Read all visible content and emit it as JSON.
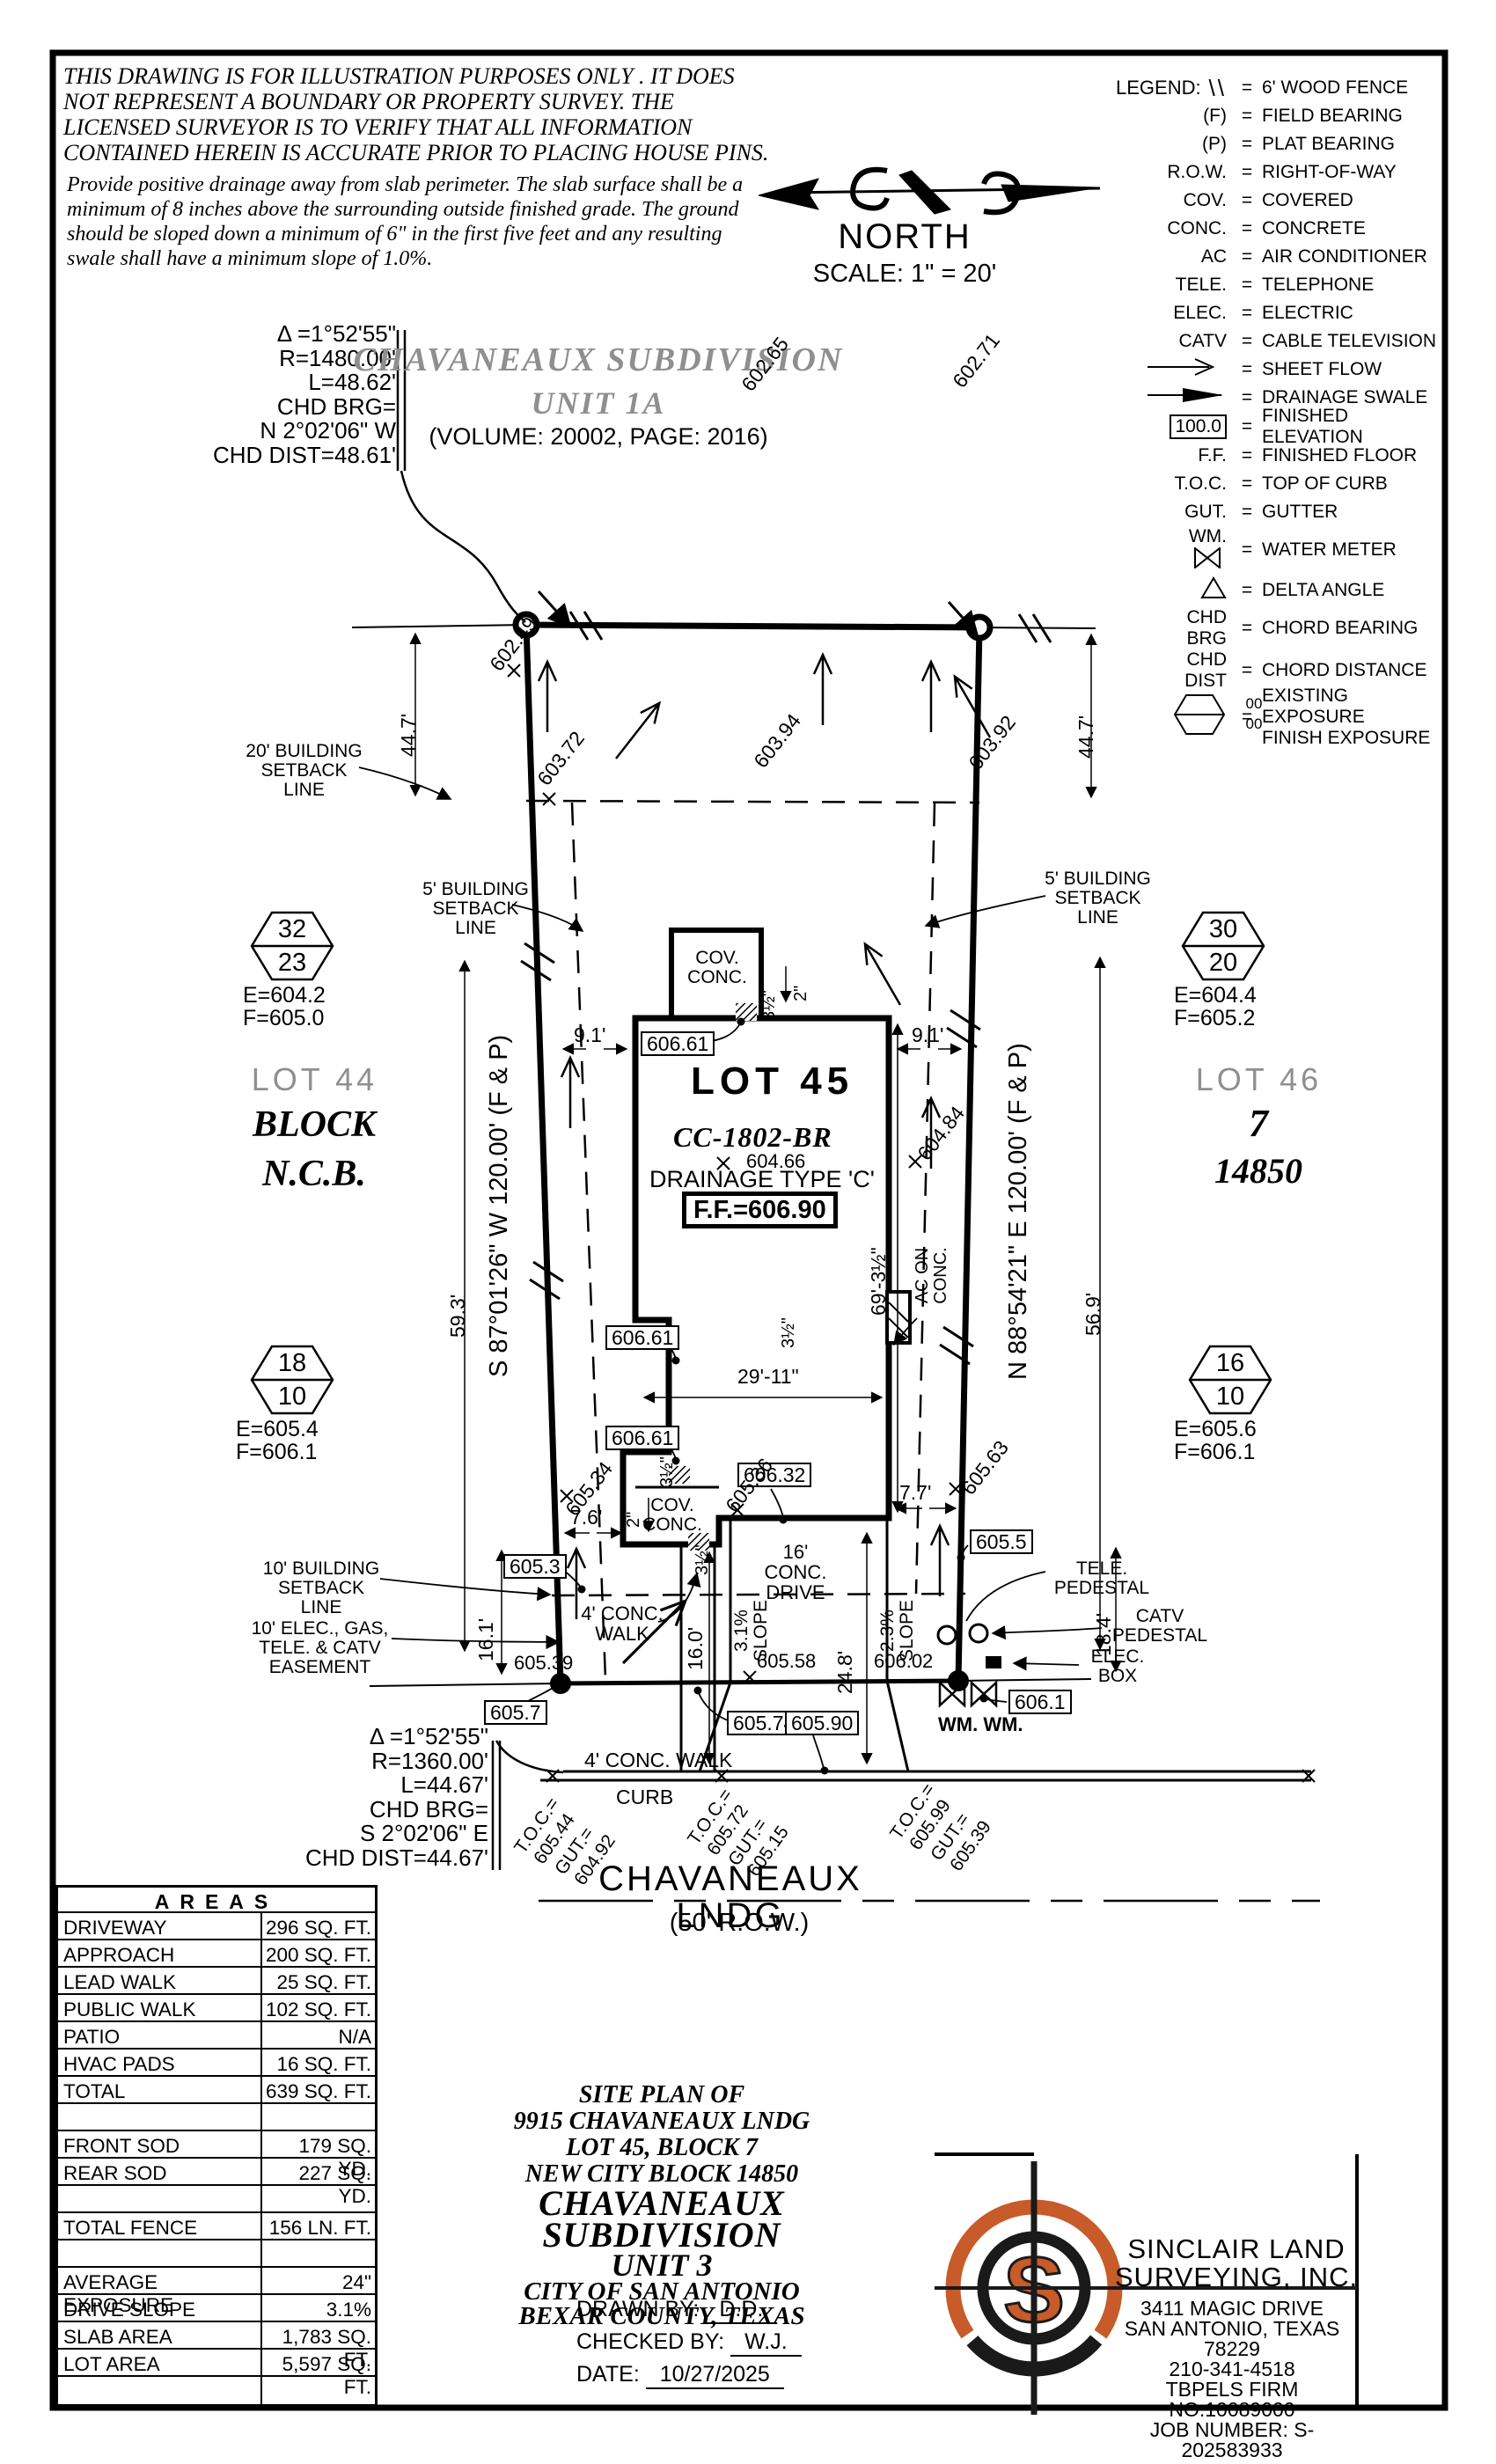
{
  "colors": {
    "accent_orange": "#C75B2A",
    "muted_gray": "#8F8F8F"
  },
  "disclaimer": {
    "para1": "THIS DRAWING IS FOR ILLUSTRATION PURPOSES ONLY . IT DOES NOT REPRESENT A BOUNDARY OR PROPERTY SURVEY. THE LICENSED SURVEYOR IS TO VERIFY THAT ALL INFORMATION CONTAINED HEREIN IS ACCURATE PRIOR TO PLACING HOUSE PINS.",
    "para2": "Provide positive drainage away from slab perimeter. The slab surface shall be a minimum of 8 inches above the surrounding outside finished grade. The ground should be sloped down a minimum of 6\" in the first five feet and any resulting swale shall have a minimum slope of 1.0%."
  },
  "north": {
    "label": "NORTH",
    "scale": "SCALE: 1\" = 20'"
  },
  "legend": {
    "title": "LEGEND:",
    "eq": "=",
    "items": [
      {
        "sym": "\\\\",
        "desc": "6' WOOD FENCE"
      },
      {
        "sym": "(F)",
        "desc": "FIELD BEARING"
      },
      {
        "sym": "(P)",
        "desc": "PLAT BEARING"
      },
      {
        "sym": "R.O.W.",
        "desc": "RIGHT-OF-WAY"
      },
      {
        "sym": "COV.",
        "desc": "COVERED"
      },
      {
        "sym": "CONC.",
        "desc": "CONCRETE"
      },
      {
        "sym": "AC",
        "desc": "AIR CONDITIONER"
      },
      {
        "sym": "TELE.",
        "desc": "TELEPHONE"
      },
      {
        "sym": "ELEC.",
        "desc": "ELECTRIC"
      },
      {
        "sym": "CATV",
        "desc": "CABLE TELEVISION"
      },
      {
        "sym": "",
        "desc": "SHEET FLOW"
      },
      {
        "sym": "",
        "desc": "DRAINAGE SWALE"
      },
      {
        "sym": "100.0",
        "desc": "FINISHED ELEVATION"
      },
      {
        "sym": "F.F.",
        "desc": "FINISHED FLOOR"
      },
      {
        "sym": "T.O.C.",
        "desc": "TOP OF CURB"
      },
      {
        "sym": "GUT.",
        "desc": "GUTTER"
      },
      {
        "sym": "WM.",
        "desc": "WATER METER"
      },
      {
        "sym": "",
        "desc": "DELTA ANGLE"
      },
      {
        "sym": "CHD BRG",
        "desc": "CHORD BEARING"
      },
      {
        "sym": "CHD DIST",
        "desc": "CHORD DISTANCE"
      },
      {
        "sym": "00",
        "sym2": "00",
        "desc": "EXISTING EXPOSURE",
        "desc2": "FINISH EXPOSURE"
      }
    ]
  },
  "subdivision_top": {
    "line1": "CHAVANEAUX SUBDIVISION",
    "line2": "UNIT 1A",
    "volume": "(VOLUME: 20002, PAGE: 2016)"
  },
  "curve_top": {
    "delta": "Δ =1°52'55\"",
    "r": "R=1480.00'",
    "len": "L=48.62'",
    "chd": "CHD BRG=",
    "brg": "N 2°02'06\" W",
    "dist": "CHD DIST=48.61'"
  },
  "curve_bottom": {
    "delta": "Δ =1°52'55\"",
    "r": "R=1360.00'",
    "len": "L=44.67'",
    "chd": "CHD BRG=",
    "brg": "S 2°02'06\" E",
    "dist": "CHD DIST=44.67'"
  },
  "plan": {
    "bearing_west": "S 87°01'26\" W  120.00'  (F & P)",
    "bearing_east": "N 88°54'21\" E  120.00'  (F & P)",
    "lot44": {
      "name": "LOT 44",
      "block": "BLOCK",
      "ncb": "N.C.B."
    },
    "lot45": {
      "name": "LOT 45",
      "model": "CC-1802-BR",
      "spot": "604.66",
      "drainage": "DRAINAGE TYPE 'C'",
      "ff": "F.F.=606.90"
    },
    "lot46": {
      "name": "LOT 46",
      "block": "7",
      "ncb": "14850"
    },
    "hexagons": [
      {
        "top": "32",
        "bottom": "23",
        "e": "E=604.2",
        "f": "F=605.0"
      },
      {
        "top": "30",
        "bottom": "20",
        "e": "E=604.4",
        "f": "F=605.2"
      },
      {
        "top": "18",
        "bottom": "10",
        "e": "E=605.4",
        "f": "F=606.1"
      },
      {
        "top": "16",
        "bottom": "10",
        "e": "E=605.6",
        "f": "F=606.1"
      }
    ],
    "setback20": "20' BUILDING SETBACK LINE",
    "setback5": "5' BUILDING SETBACK LINE",
    "setback10": "10' BUILDING SETBACK LINE",
    "easement": "10' ELEC., GAS, TELE. & CATV EASEMENT",
    "cov_conc": "COV. CONC.",
    "ac_on_conc": "AC ON CONC.",
    "tele_pedestal": "TELE. PEDESTAL",
    "catv_pedestal": "CATV PEDESTAL",
    "elec_box": "ELEC. BOX",
    "wm": "WM.  WM.",
    "walk4": "4' CONC. WALK",
    "drive16": "16' CONC. DRIVE",
    "slope31": "3.1% SLOPE",
    "slope23": "2.3% SLOPE",
    "curb": "CURB",
    "street_name": "CHAVANEAUX LNDG",
    "street_row": "(50' R.O.W.)",
    "toc": [
      {
        "t": "T.O.C.=",
        "tv": "605.44",
        "g": "GUT.=",
        "gv": "604.92"
      },
      {
        "t": "T.O.C.=",
        "tv": "605.72",
        "g": "GUT.=",
        "gv": "605.15"
      },
      {
        "t": "T.O.C.=",
        "tv": "605.99",
        "g": "GUT.=",
        "gv": "605.39"
      }
    ],
    "boxes": {
      "e60661": "606.61",
      "e60632": "606.32",
      "e6053": "605.3",
      "e6055": "605.5",
      "e6057": "605.7",
      "e60574": "605.74",
      "e60590": "605.90",
      "e6061": "606.1"
    },
    "spots": {
      "s60249": "602.49",
      "s60265": "602.65",
      "s60271": "602.71",
      "s60372": "603.72",
      "s60394": "603.94",
      "s60392": "603.92",
      "s60484": "604.84",
      "s60534": "605.34",
      "s60536": "605.36",
      "s60563": "605.63",
      "s60539": "605.39",
      "s60558": "605.58",
      "s60602": "606.02"
    },
    "dims": {
      "d447": "44.7'",
      "d593": "59.3'",
      "d569": "56.9'",
      "d91": "9.1'",
      "d76": "7.6'",
      "d77": "7.7'",
      "d160": "16.0'",
      "d161": "16.1'",
      "d184": "18.4'",
      "d248": "24.8'",
      "d2911": "29'-11\"",
      "d693": "69'-3½\"",
      "d35": "3½\"",
      "d2": "2\""
    }
  },
  "areas": {
    "title": "AREAS",
    "rows": [
      {
        "label": "DRIVEWAY",
        "value": "296 SQ. FT."
      },
      {
        "label": "APPROACH",
        "value": "200 SQ. FT."
      },
      {
        "label": "LEAD WALK",
        "value": "25 SQ. FT."
      },
      {
        "label": "PUBLIC WALK",
        "value": "102 SQ. FT."
      },
      {
        "label": "PATIO",
        "value": "N/A"
      },
      {
        "label": "HVAC PADS",
        "value": "16 SQ. FT."
      },
      {
        "label": "TOTAL",
        "value": "639 SQ. FT."
      },
      {
        "label": "",
        "value": ""
      },
      {
        "label": "FRONT SOD",
        "value": "179 SQ. YD."
      },
      {
        "label": "REAR SOD",
        "value": "227 SQ. YD."
      },
      {
        "label": "",
        "value": ""
      },
      {
        "label": "TOTAL FENCE",
        "value": "156 LN. FT."
      },
      {
        "label": "",
        "value": ""
      },
      {
        "label": "AVERAGE EXPOSURE",
        "value": "24\""
      },
      {
        "label": "DRIVE SLOPE",
        "value": "3.1%"
      },
      {
        "label": "SLAB AREA",
        "value": "1,783 SQ. FT."
      },
      {
        "label": "LOT AREA",
        "value": "5,597 SQ. FT."
      },
      {
        "label": "",
        "value": ""
      }
    ]
  },
  "title_block": {
    "l1": "SITE PLAN OF",
    "l2": "9915 CHAVANEAUX LNDG",
    "l3": "LOT 45, BLOCK 7",
    "l4": "NEW CITY BLOCK 14850",
    "l5": "CHAVANEAUX SUBDIVISION",
    "l6": "UNIT 3",
    "l7": "CITY OF SAN ANTONIO",
    "l8": "BEXAR COUNTY, TEXAS",
    "drawn_label": "DRAWN BY:",
    "drawn": "D.D.",
    "checked_label": "CHECKED BY:",
    "checked": "W.J.",
    "date_label": "DATE:",
    "date": "10/27/2025"
  },
  "firm": {
    "name1": "SINCLAIR LAND",
    "name2": "SURVEYING, INC.",
    "addr1": "3411 MAGIC DRIVE",
    "addr2": "SAN ANTONIO, TEXAS 78229",
    "phone": "210-341-4518",
    "tbpels": "TBPELS FIRM NO.10089000",
    "job": "JOB NUMBER: S-202583933",
    "logo_letter": "S"
  }
}
